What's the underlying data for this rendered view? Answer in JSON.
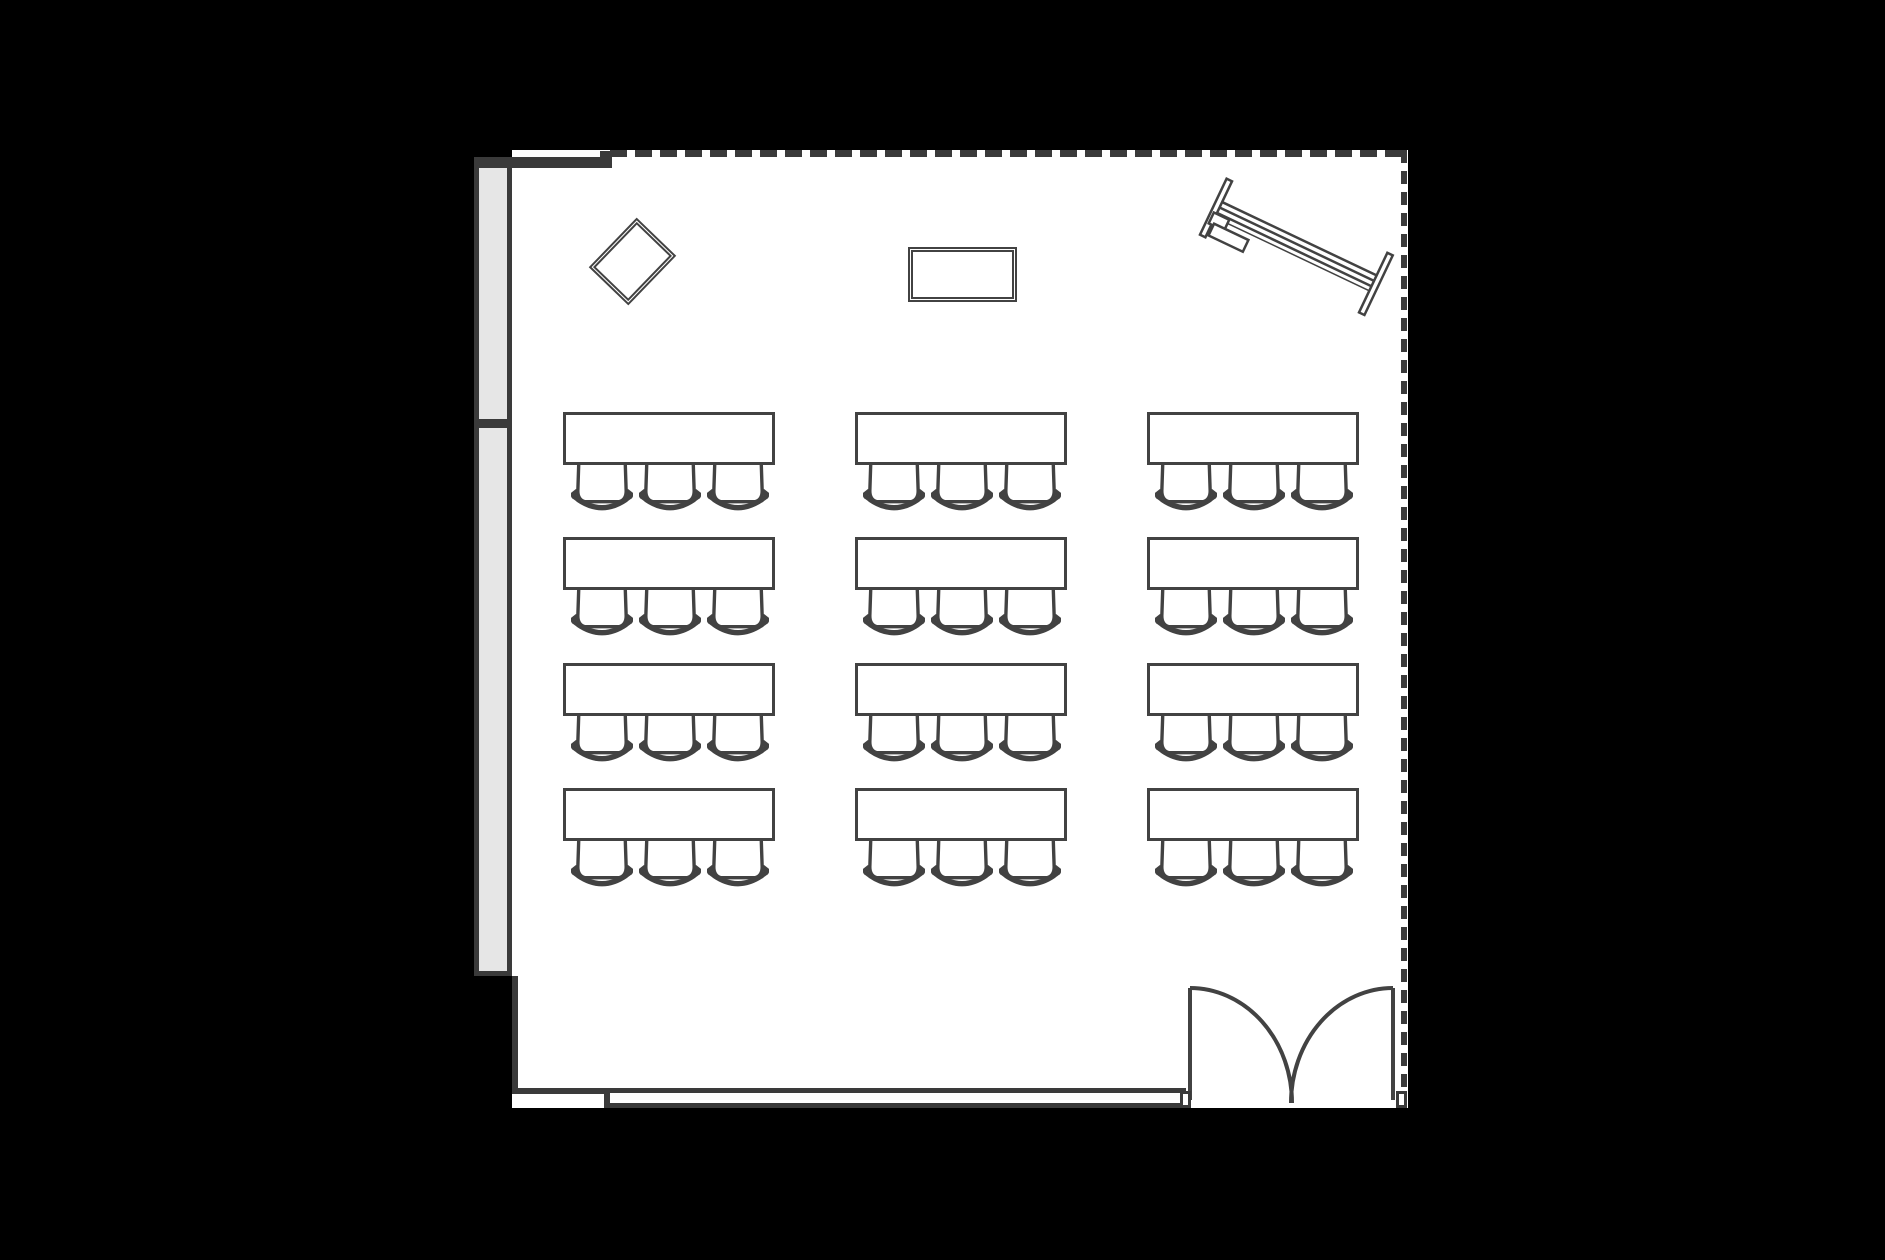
{
  "scene": {
    "type": "floor-plan",
    "room_label": "seminar-room-classroom-layout",
    "background_color": "#000000"
  },
  "colors": {
    "background": "#000000",
    "wall": "#3a3a3a",
    "line": "#424242",
    "floor": "#ffffff",
    "partition_fill": "#e6e6e6"
  },
  "walls": {
    "top": {
      "style_left_segment": "solid",
      "style_main": "dashed"
    },
    "right": {
      "style": "dashed"
    },
    "left": {
      "style": "partition-strip",
      "segments": 2
    },
    "bottom": {
      "style": "double-line",
      "opening": "double-door"
    }
  },
  "door": {
    "type": "double-swing-door",
    "leaves": 2,
    "title": "Double door"
  },
  "symbols": [
    {
      "name": "whiteboard-diamond",
      "shape": "rotated-rectangle",
      "title": "Whiteboard (angled)"
    },
    {
      "name": "presentation-board",
      "shape": "rectangle",
      "title": "Presentation board"
    },
    {
      "name": "projection-screen",
      "shape": "angled-trolley",
      "title": "Projection screen on stand"
    }
  ],
  "furniture": {
    "desk_rows": 4,
    "desk_columns": 3,
    "desk_count": 12,
    "chairs_per_desk": 3,
    "chair_count": 36,
    "desk_title": "Desk",
    "chair_title": "Chair",
    "grid": {
      "cols_x": [
        563,
        855,
        1147
      ],
      "rows_y": [
        412,
        537,
        663,
        788
      ],
      "desk_w": 212,
      "desk_h": 53,
      "chair_w": 62,
      "chair_offsets": [
        8,
        76,
        144
      ]
    }
  }
}
